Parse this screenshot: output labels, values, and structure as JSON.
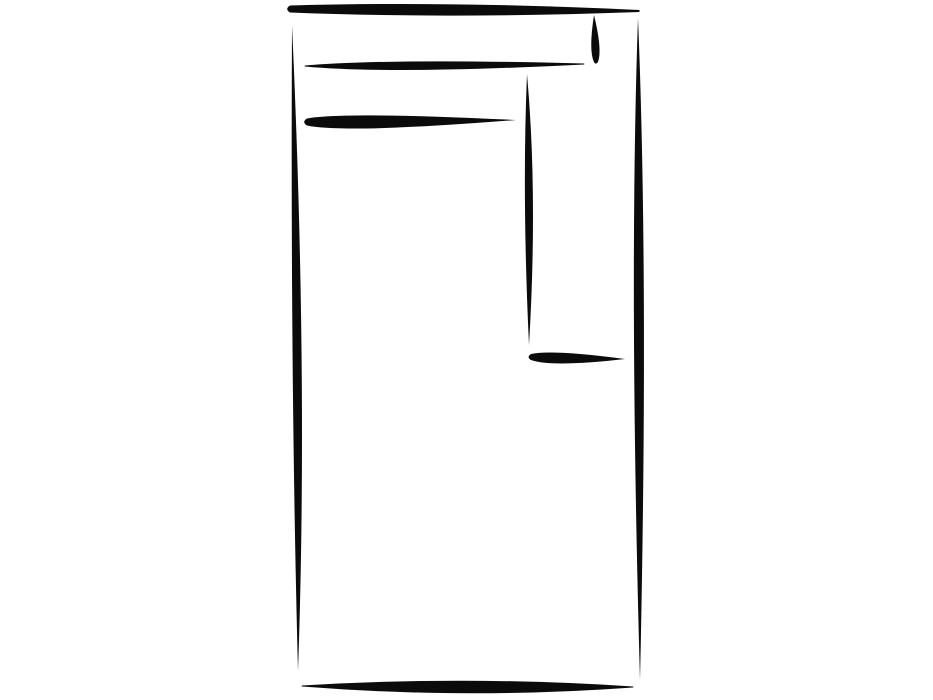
{
  "canvas": {
    "width": 933,
    "height": 700,
    "background": "#ffffff"
  },
  "drawing": {
    "description": "Hand-drawn black brush-stroke outline of a tall rectangle with interior lines (furniture footprint sketch)",
    "ink_color": "#0b0b0b",
    "strokes": [
      {
        "name": "top-edge",
        "x1": 290,
        "y1": 9,
        "x2": 639,
        "y2": 11,
        "w": 9,
        "t": 0.45,
        "w1": 7,
        "w2": 2,
        "bow": 0
      },
      {
        "name": "left-edge",
        "x1": 292,
        "y1": 25,
        "x2": 298,
        "y2": 671,
        "w": 9,
        "t": 0.55,
        "w1": 0,
        "w2": 0,
        "bow": -4
      },
      {
        "name": "right-edge",
        "x1": 638,
        "y1": 18,
        "x2": 640,
        "y2": 680,
        "w": 10,
        "t": 0.4,
        "w1": 0,
        "w2": 0,
        "bow": 0
      },
      {
        "name": "bottom-edge",
        "x1": 302,
        "y1": 686,
        "x2": 633,
        "y2": 687,
        "w": 12,
        "t": 0.5,
        "w1": 1,
        "w2": 1,
        "bow": 1
      },
      {
        "name": "inner-back-line",
        "x1": 305,
        "y1": 66,
        "x2": 584,
        "y2": 64,
        "w": 8,
        "t": 0.3,
        "w1": 1,
        "w2": 1,
        "bow": 1
      },
      {
        "name": "inner-seat-line",
        "x1": 307,
        "y1": 122,
        "x2": 516,
        "y2": 120,
        "w": 11,
        "t": 0.18,
        "w1": 7,
        "w2": 0,
        "bow": 1
      },
      {
        "name": "top-right-tick",
        "x1": 594,
        "y1": 15,
        "x2": 596,
        "y2": 62,
        "w": 7,
        "t": 0.75,
        "w1": 0,
        "w2": 4,
        "bow": 0
      },
      {
        "name": "inner-vertical-line",
        "x1": 527,
        "y1": 74,
        "x2": 529,
        "y2": 345,
        "w": 8,
        "t": 0.45,
        "w1": 0,
        "w2": 0,
        "bow": -2
      },
      {
        "name": "mid-right-line",
        "x1": 531,
        "y1": 357,
        "x2": 625,
        "y2": 359,
        "w": 9,
        "t": 0.22,
        "w1": 6,
        "w2": 0,
        "bow": 1
      }
    ]
  }
}
